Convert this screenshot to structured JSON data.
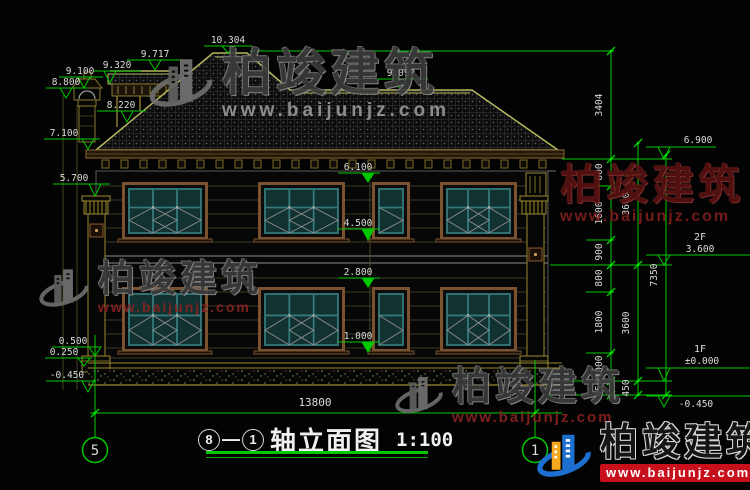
{
  "meta": {
    "drawing_type": "建筑立面图",
    "bg_color": "#030303"
  },
  "colors": {
    "dim_green": "#00c800",
    "dim_text": "#dcdcdc",
    "roof_edge": "#b8b860",
    "trim_olive": "#9a8a30",
    "window_teal": "#347a7a",
    "frame_brown": "#7a5230",
    "watermark_red": "#8b2323",
    "logo_blue": "#1d6fd1",
    "logo_orange": "#f5a81c"
  },
  "watermark": {
    "brand": "柏竣建筑",
    "url": "www.baijunjz.com"
  },
  "title": {
    "axis_left": "8",
    "axis_sep": "—",
    "axis_right": "1",
    "name": "轴立面图",
    "scale": "1:100"
  },
  "grid": {
    "left_bubble": "5",
    "right_bubble": "1"
  },
  "dims": {
    "d10304": "10.304",
    "d9717": "9.717",
    "d9320": "9.320",
    "d9100": "9.100",
    "d8800": "8.800",
    "d8220": "8.220",
    "d9092": "9.092",
    "d7100": "7.100",
    "d5700": "5.700",
    "d0500": "0.500",
    "d0250": "0.250",
    "dm0450L": "-0.450",
    "d6100": "6.100",
    "d4500": "4.500",
    "d2800": "2.800",
    "d1000": "1.000",
    "d6900": "6.900",
    "f2": "2F",
    "d3600f": "3.600",
    "f1": "1F",
    "d0000": "±0.000",
    "dm0450R": "-0.450",
    "roof_h": "3404",
    "total_h": "7350",
    "width": "13800",
    "chain_a": [
      "800",
      "1600",
      "900",
      "800",
      "1800",
      "1000",
      "450"
    ],
    "chain_b": [
      "3600",
      "3600",
      "450"
    ]
  }
}
